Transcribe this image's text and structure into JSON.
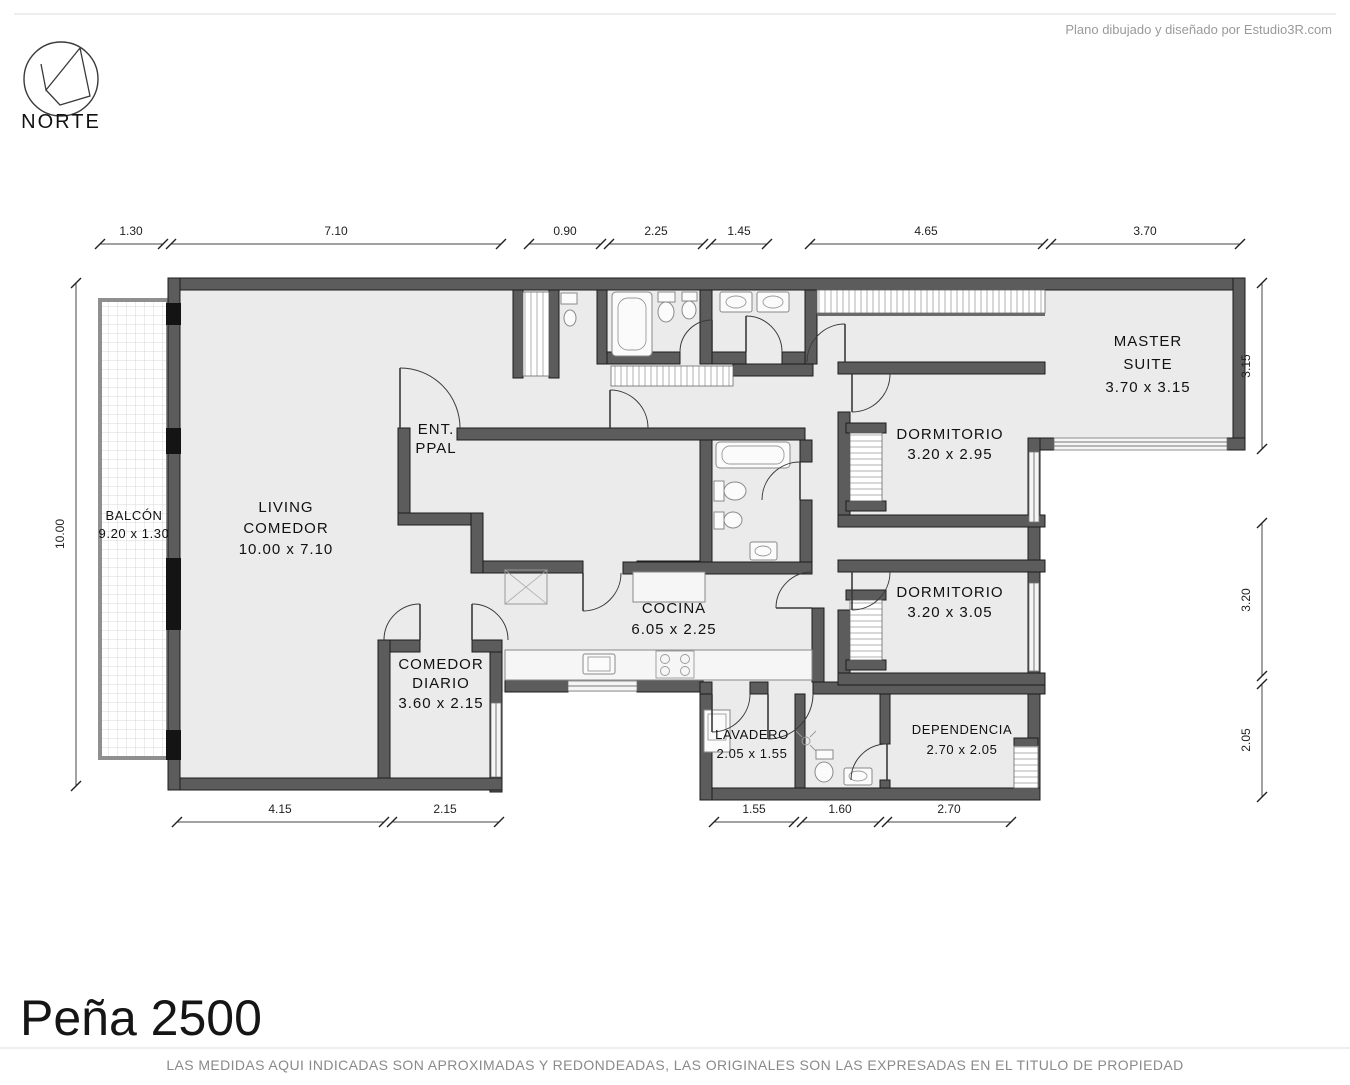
{
  "header": {
    "attribution": "Plano dibujado y diseñado por Estudio3R.com",
    "north_label": "NORTE"
  },
  "rooms": {
    "balcon": {
      "name": "BALCÓN",
      "dims": "9.20 x 1.30"
    },
    "living": {
      "name": "LIVING",
      "name2": "COMEDOR",
      "dims": "10.00 x 7.10"
    },
    "entrada": {
      "name": "ENT.",
      "name2": "PPAL"
    },
    "comedor_diario": {
      "name": "COMEDOR",
      "name2": "DIARIO",
      "dims": "3.60 x 2.15"
    },
    "cocina": {
      "name": "COCINA",
      "dims": "6.05 x 2.25"
    },
    "lavadero": {
      "name": "LAVADERO",
      "dims": "2.05 x 1.55"
    },
    "dependencia": {
      "name": "DEPENDENCIA",
      "dims": "2.70 x 2.05"
    },
    "dormitorio1": {
      "name": "DORMITORIO",
      "dims": "3.20 x 2.95"
    },
    "dormitorio2": {
      "name": "DORMITORIO",
      "dims": "3.20 x 3.05"
    },
    "master_suite": {
      "name": "MASTER",
      "name2": "SUITE",
      "dims": "3.70 x 3.15"
    }
  },
  "dims": {
    "top": [
      "1.30",
      "7.10",
      "0.90",
      "2.25",
      "1.45",
      "4.65",
      "3.70"
    ],
    "left": [
      "10.00"
    ],
    "right": [
      "3.15",
      "3.20",
      "2.05"
    ],
    "bottom_left": [
      "4.15",
      "2.15"
    ],
    "bottom_right": [
      "1.55",
      "1.60",
      "2.70"
    ]
  },
  "footer": {
    "title": "Peña 2500",
    "disclaimer": "LAS MEDIDAS AQUI INDICADAS SON APROXIMADAS Y REDONDEADAS, LAS ORIGINALES SON LAS EXPRESADAS EN EL TITULO DE PROPIEDAD"
  },
  "colors": {
    "wall": "#5c5c5c",
    "floor": "#ebebeb",
    "hatch": "#b0b0b0",
    "dim_text": "#222222",
    "muted_text": "#999999"
  }
}
